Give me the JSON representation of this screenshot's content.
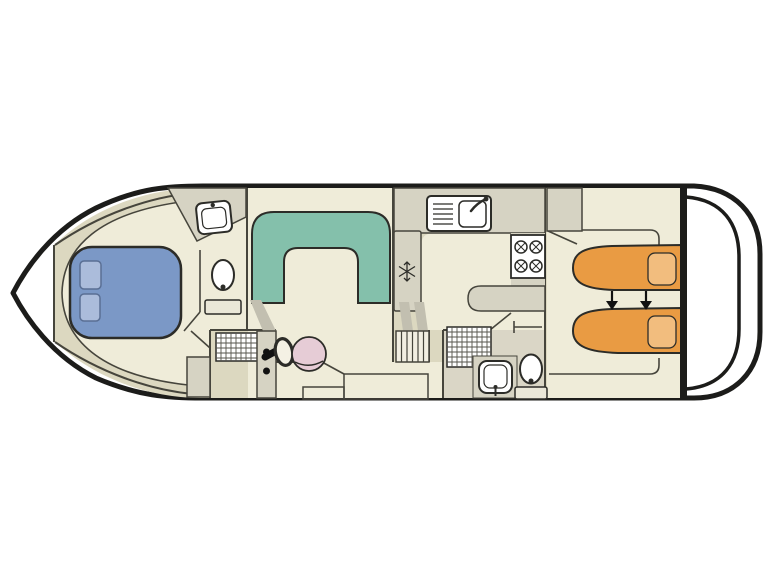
{
  "palette": {
    "background": "#ffffff",
    "hull_line": "#1c1c1a",
    "wall_line": "#46453c",
    "dark_outline": "#2c2c28",
    "deck_khaki": "#dcd8c0",
    "cabin_cream": "#efecd9",
    "counter_gray": "#d6d3c3",
    "shade_gray": "#c2bfb0",
    "bathroom_floor": "#dad6c6",
    "stair_white": "#f2efe2",
    "dinette_teal": "#84c0ab",
    "bed_blue": "#7b98c6",
    "pillow_blue": "#abbcdb",
    "pillow_blue_edge": "#5a6f94",
    "bed_orange": "#e99b43",
    "pillow_orange": "#f2bd7e",
    "seat_pink": "#e6ccd6",
    "fixture_white": "#ffffff",
    "fixture_base": "#eae7d8",
    "grid_line": "#55544c",
    "arrow_black": "#111111",
    "wheel_face": "#f4f1e4"
  },
  "icons": [
    "double-bed-icon",
    "pillow-icon",
    "u-dinette-icon",
    "washbasin-icon",
    "toilet-icon",
    "galley-sink-icon",
    "stove-burner-icon",
    "snowflake-fridge-icon",
    "companionway-stairs-icon",
    "shower-grate-icon",
    "instrument-panel-icon",
    "helm-wheel-icon",
    "helm-seat-icon",
    "wardrobe-icon",
    "single-bed-icon",
    "bed-convert-arrow-icon",
    "swim-platform-icon"
  ]
}
